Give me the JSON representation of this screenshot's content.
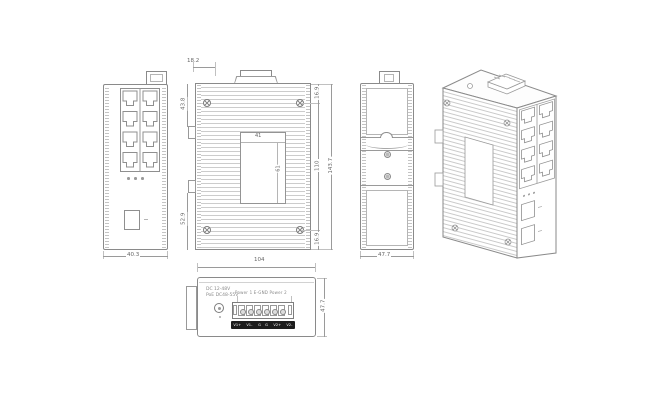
{
  "drawing_title": "industrial-ethernet-switch-dimension-drawing",
  "colors": {
    "background": "#ffffff",
    "outline": "#8a8a8a",
    "fin": "#cccccc",
    "dim_text": "#666666",
    "terminal_strip": "#1d1d1d"
  },
  "views": {
    "front": {
      "width": "40.3",
      "port_count": 8,
      "led_count": 3
    },
    "rear": {
      "top_offset": "18.2",
      "left_upper": "43.8",
      "left_lower": "52.9",
      "right_top": "16.9",
      "right_middle": "110",
      "right_bottom": "16.9",
      "right_overall": "143.7",
      "plate_width": "41",
      "plate_height": "61"
    },
    "side": {
      "width": "47.7"
    },
    "bottom": {
      "width": "104",
      "depth": "47.7",
      "spec_line1": "DC 12-48V",
      "spec_line2": "PoE DC48-55V",
      "power_label": "Power 1   E-GND   Power 2",
      "terminal_labels": [
        "V1+",
        "V1-",
        "G",
        "G",
        "V2+",
        "V2-"
      ]
    }
  }
}
